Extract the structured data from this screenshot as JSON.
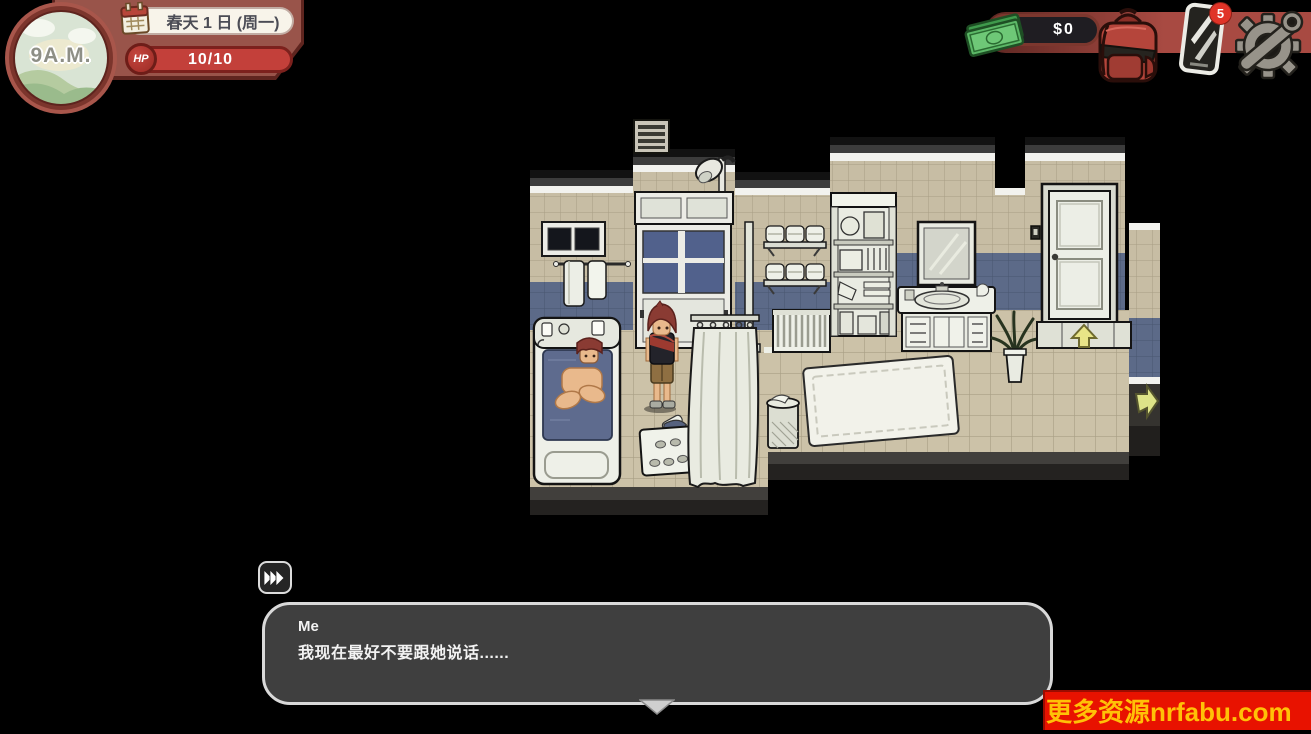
{
  "hud": {
    "time": "9A.M.",
    "date": "春天 1 日 (周一)",
    "hp": {
      "label": "HP",
      "value": "10/10"
    },
    "money": "$0",
    "phone_badge_count": "5",
    "icons": {
      "calendar": "calendar-icon",
      "cash": "cash-icon",
      "backpack": "backpack-icon",
      "phone": "phone-icon",
      "settings": "gear-icon"
    },
    "colors": {
      "backdrop": "#99544a",
      "hp_bar": "#c3403a",
      "band": "#a84a42"
    }
  },
  "scene": {
    "location": "bathroom",
    "objects": [
      "air-vent",
      "shower-head",
      "shower-glass-door",
      "bathroom-window",
      "towel-rail",
      "wall-towel-shelves",
      "storage-shelf",
      "radiator",
      "water-pipe",
      "bathtub",
      "bathing-npc",
      "player-character",
      "laundry-basket",
      "shower-curtain",
      "waste-hamper",
      "bath-rug",
      "sink-vanity",
      "mirror",
      "potted-plant",
      "bathroom-door",
      "light-switch",
      "exit-up-indicator",
      "exit-right-indicator"
    ],
    "colors": {
      "wall_tile": "#c7bda4",
      "wall_tile_blue": "#5c6a88",
      "floor_tile": "#ccc2a8"
    }
  },
  "dialogue": {
    "speaker": "Me",
    "text": "我现在最好不要跟她说话......"
  },
  "watermark": {
    "text": "更多资源nrfabu.com",
    "bg": "#e81200",
    "fg": "#ffc107"
  }
}
